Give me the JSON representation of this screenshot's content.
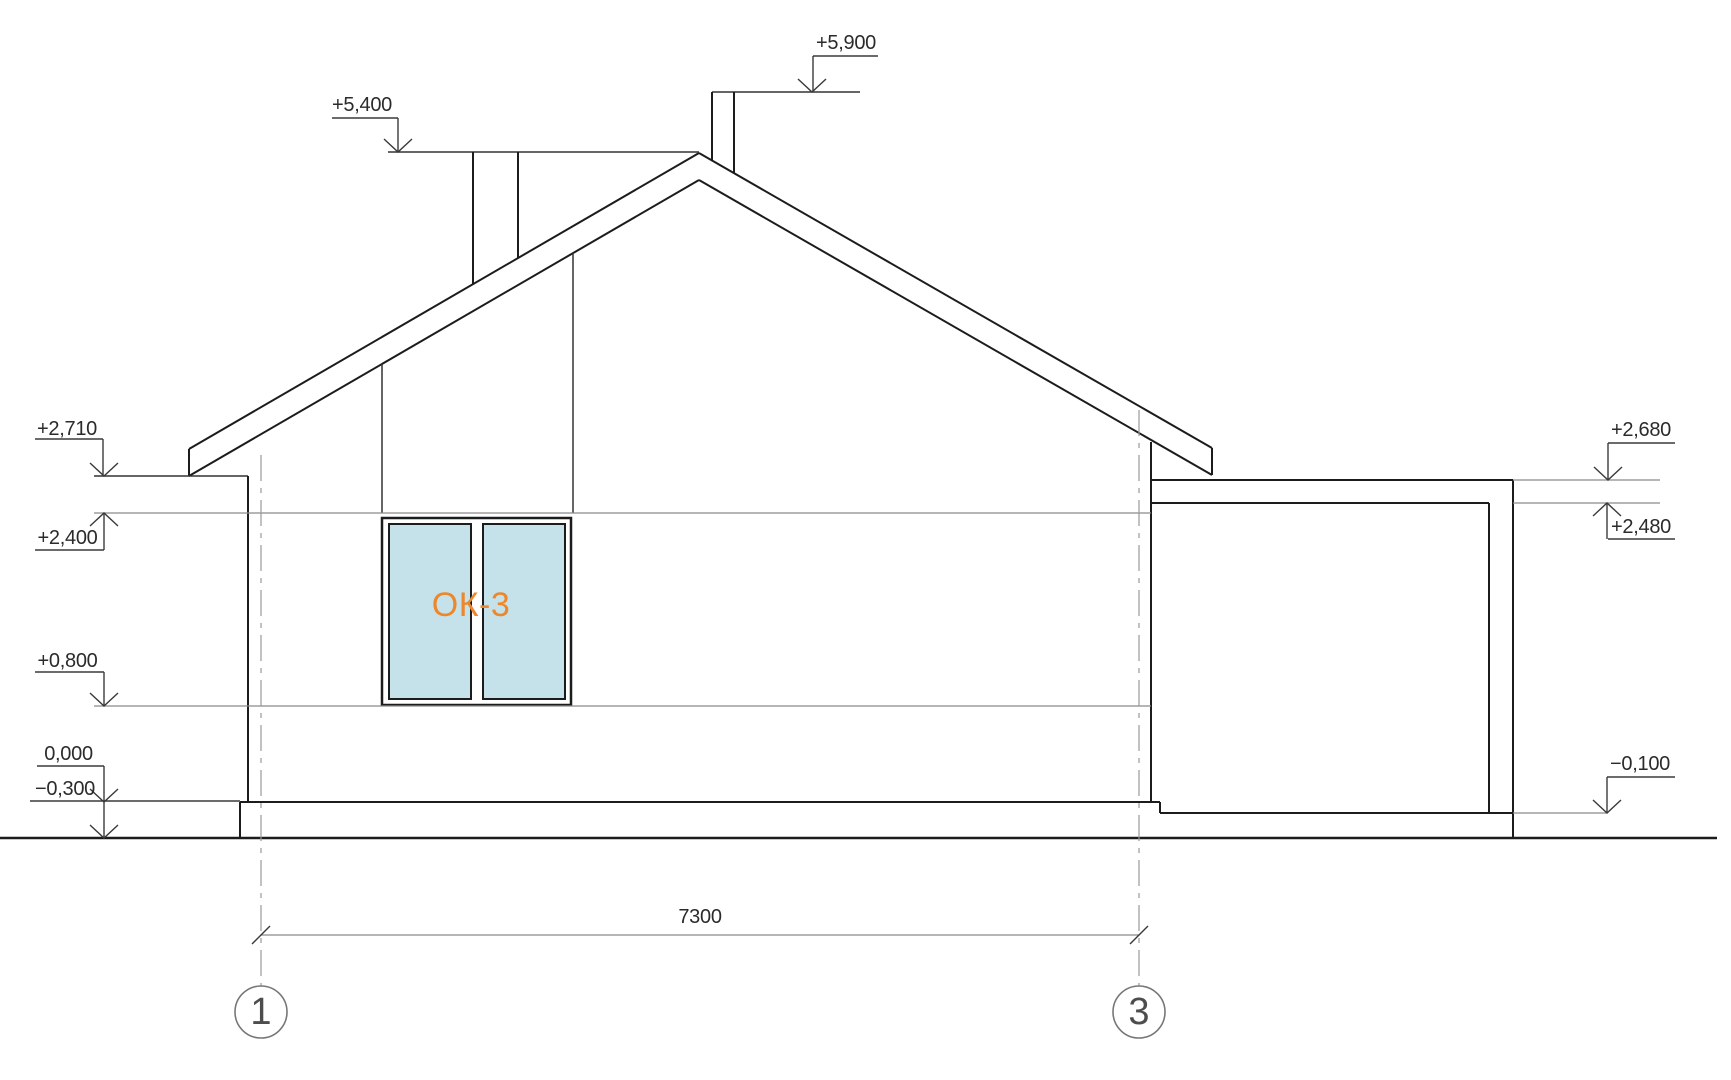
{
  "drawing": {
    "type": "architectural-elevation",
    "description": "Side elevation of a gable-roof house with attached flat-roof annex",
    "colors": {
      "line": "#1c1c1c",
      "thin_line": "#8a8a8a",
      "window_glass": "#c5e2ea",
      "window_tag": "#ed872b",
      "background": "#ffffff"
    }
  },
  "elevation_marks": {
    "ridge_chimney_right": "+5,900",
    "chimney_left_top": "+5,400",
    "eave_left": "+2,710",
    "window_head": "+2,400",
    "window_sill": "+0,800",
    "floor_zero": "0,000",
    "ground_left": "−0,300",
    "annex_roof_top": "+2,680",
    "annex_ceiling": "+2,480",
    "annex_floor": "−0,100"
  },
  "window": {
    "tag": "ОК-3"
  },
  "dimension": {
    "axis_span": "7300"
  },
  "axes": {
    "left_bubble": "1",
    "right_bubble": "3"
  }
}
